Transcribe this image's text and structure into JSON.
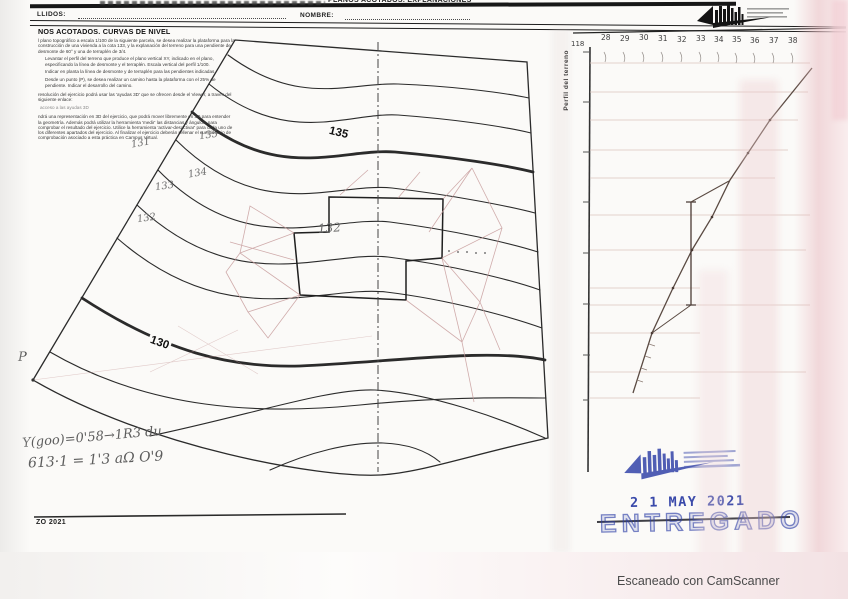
{
  "document": {
    "header_strip_title": "PLANOS ACOTADOS. EXPLANACIONES",
    "surname_label": "LLIDOS:",
    "name_label": "NOMBRE:",
    "footer_code": "ZO 2021",
    "scanner_credit": "Escaneado con CamScanner"
  },
  "instructions": {
    "title": "NOS ACOTADOS. CURVAS DE NIVEL",
    "paragraphs": [
      "l plano topográfico a escala 1/100 de la siguiente parcela, se desea realizar la plataforma para la construcción de una vivienda a la cota 133, y la explanación del terreno para una pendiente de desmonte de 60° y una de terraplén de 3/4.",
      "Levantar el perfil del terreno que produce el plano vertical XY, indicado en el plano, especificando la línea de desmonte y el terraplén. Escala vertical del perfil 1/100.",
      "Indicar en planta la línea de desmonte y de terraplén para las pendientes indicadas.",
      "Desde un punto (P), se desea realizar un camino hasta la plataforma con el 25% de pendiente. Indicar el desarrollo del camino.",
      "resolución del ejercicio podrá usar las 'ayudas 3D' que se ofrecen desde el Viewer, a través del siguiente enlace:",
      "acceso a las ayudas 3D",
      "ndrá una representación en 3D del ejercicio, que podrá mover libremente en 3D para entender la geometría. Además podrá utilizar la herramienta 'medir' las distancias y ángulos, para comprobar el resultado del ejercicio. Utilice la herramienta 'activar-desactivar' para cada uno de los diferentes apartados del ejercicio. Al finalizar el ejercicio deberán rellenar el cuestionario de comprobación asociado a esta práctica en Campus Virtual."
    ]
  },
  "map": {
    "point_label": "P",
    "printed_contour_labels": [
      "135",
      "130"
    ],
    "pencil_labels": [
      "131",
      "135",
      "134",
      "133",
      "132"
    ],
    "platform_label": "132"
  },
  "profile": {
    "axis_label": "Perfil del terreno",
    "corner_value": "118",
    "top_values": [
      "28",
      "29",
      "30",
      "31",
      "32",
      "33",
      "34",
      "35",
      "36",
      "37",
      "38"
    ]
  },
  "stamps": {
    "date": "2 1 MAY 2021",
    "received_text": "ENTREGADO"
  },
  "handwritten_notes": {
    "line1": "Y(goo)=0'58→1R3 du",
    "line2": "613·1 = 1'3 aΩ O'9"
  },
  "colors": {
    "stamp_blue": "#2b3da6",
    "pencil_gray": "#6e6e6e",
    "construction_pink": "#c59898",
    "ink_black": "#222222"
  }
}
